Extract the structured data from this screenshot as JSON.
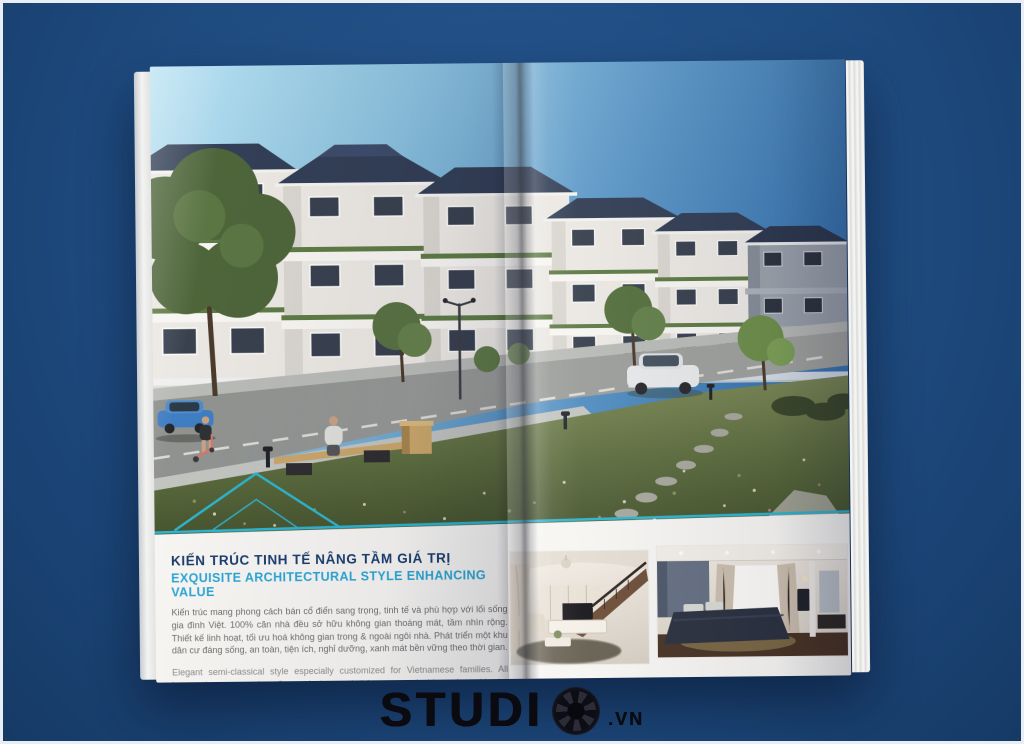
{
  "colors": {
    "background_blue": "#1e4b80",
    "accent_teal": "#2fb4cf",
    "title_navy": "#1c3e6e",
    "title_cyan": "#2ba6d4",
    "body_text_gray": "#6f6f6f",
    "roof_navy": "#333f56",
    "logo_black": "#0a0a10"
  },
  "brochure": {
    "section": {
      "title_vi": "KIẾN TRÚC TINH TẾ NÂNG TẦM GIÁ TRỊ",
      "title_en": "EXQUISITE ARCHITECTURAL STYLE ENHANCING VALUE",
      "body_vi": "Kiến trúc mang phong cách bán cổ điển sang trọng, tinh tế và phù hợp với lối sống gia đình Việt. 100% căn nhà đều sở hữu không gian thoáng mát, tầm nhìn rộng. Thiết kế linh hoạt, tối ưu hoá không gian trong & ngoài ngôi nhà. Phát triển một khu dân cư đáng sống, an toàn, tiện ích, nghỉ dưỡng, xanh mát bền vững theo thời gian.",
      "body_en": "Elegant semi-classical style especially customized for Vietnamese families. All houses have great view. Smart design, optimizing spaces inside and outside the house. A worthy place for living, safety, fully amenities and green by the time."
    },
    "icons": {
      "accent_roofline": "roof-outline-icon"
    }
  },
  "footer_logo": {
    "brand": "STUDI",
    "icon": "aperture-icon",
    "domain": ".VN"
  }
}
